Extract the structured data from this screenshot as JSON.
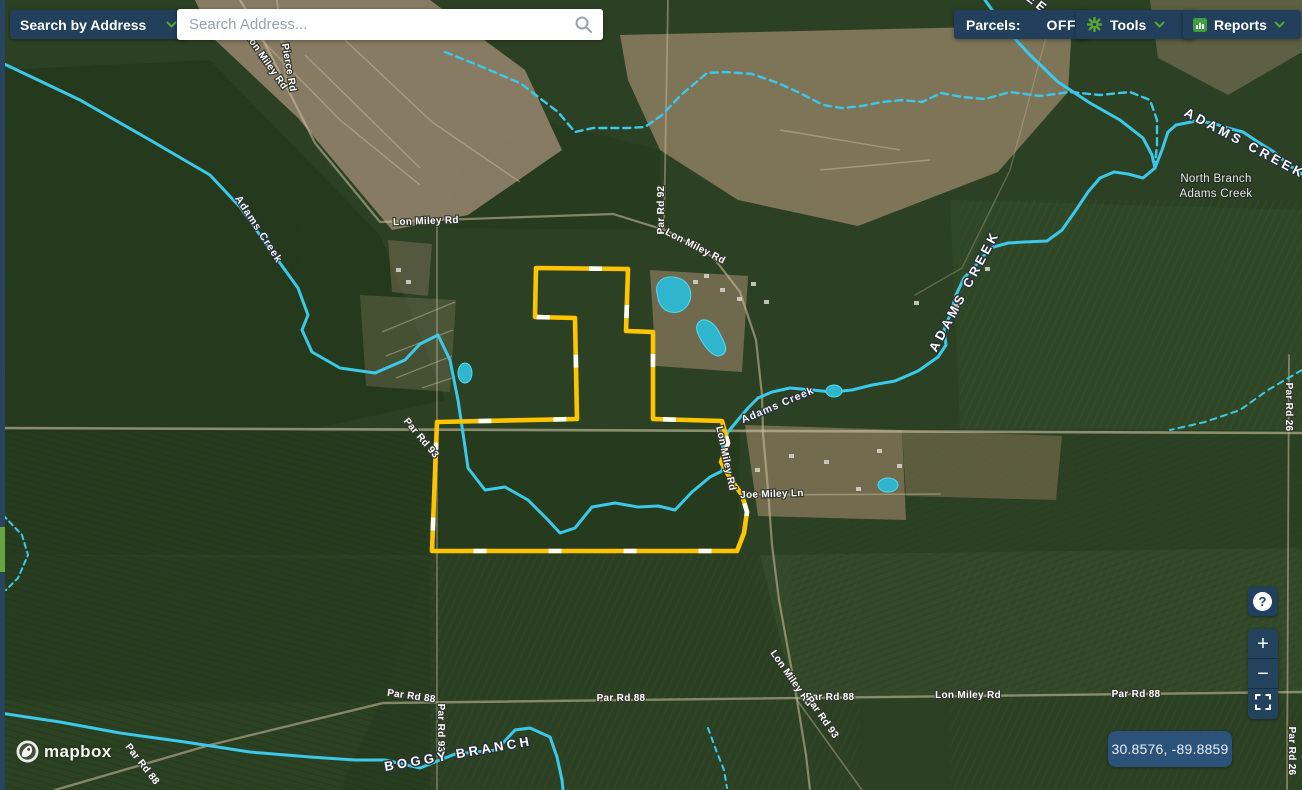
{
  "header": {
    "search_by": {
      "label": "Search by Address"
    },
    "search": {
      "placeholder": "Search Address..."
    },
    "parcels": {
      "label": "Parcels:",
      "state": "OFF"
    },
    "tools": {
      "label": "Tools"
    },
    "reports": {
      "label": "Reports"
    }
  },
  "controls": {
    "help": "?",
    "zoom_in": "+",
    "zoom_out": "−"
  },
  "footer": {
    "attribution": "mapbox",
    "coordinates": "30.8576, -89.8859"
  },
  "colors": {
    "navy_button": "#22405b",
    "accent_green": "#5aa431",
    "parcel_yellow": "#ffc400",
    "creek_cyan": "#3cc9e9",
    "coords_bg": "#2b5278"
  },
  "map_labels": [
    {
      "id": "lon-miley-rd-nw",
      "text": "Lon Miley Rd",
      "x": 264,
      "y": 63,
      "r": 55,
      "cls": "lbl-rd"
    },
    {
      "id": "pierce-rd",
      "text": "Pierce Rd",
      "x": 286,
      "y": 68,
      "r": 80,
      "cls": "lbl-rd"
    },
    {
      "id": "lon-miley-rd-w",
      "text": "Lon Miley Rd",
      "x": 426,
      "y": 224,
      "r": -2,
      "cls": "lbl-rd"
    },
    {
      "id": "par-rd-92",
      "text": "Par Rd 92",
      "x": 664,
      "y": 210,
      "r": -90,
      "cls": "lbl-rd"
    },
    {
      "id": "lon-miley-rd-ne",
      "text": "Lon Miley Rd",
      "x": 694,
      "y": 249,
      "r": 27,
      "cls": "lbl-rd"
    },
    {
      "id": "adams-creek-nw",
      "text": "Adams Creek",
      "x": 256,
      "y": 231,
      "r": 57,
      "cls": "lbl-creek-sm"
    },
    {
      "id": "creek-letters-top",
      "text": "EE",
      "x": 1035,
      "y": 7,
      "r": 38,
      "cls": "lbl-creek"
    },
    {
      "id": "adams-creek-upper",
      "text": "ADAMS CREEK",
      "x": 968,
      "y": 293,
      "r": -62,
      "cls": "lbl-creek"
    },
    {
      "id": "adams-creek-ne",
      "text": "ADAMS CREEK",
      "x": 1243,
      "y": 147,
      "r": 28,
      "cls": "lbl-creek"
    },
    {
      "id": "north-branch-line1",
      "text": "North Branch",
      "x": 1216,
      "y": 182,
      "r": 0,
      "cls": "lbl-place"
    },
    {
      "id": "north-branch-line2",
      "text": "Adams Creek",
      "x": 1216,
      "y": 197,
      "r": 0,
      "cls": "lbl-place"
    },
    {
      "id": "adams-creek-mid",
      "text": "Adams Creek",
      "x": 779,
      "y": 408,
      "r": -23,
      "cls": "lbl-creek-sm"
    },
    {
      "id": "lon-miley-rd-e",
      "text": "Lon Miley Rd",
      "x": 723,
      "y": 459,
      "r": 78,
      "cls": "lbl-rd"
    },
    {
      "id": "joe-miley-ln",
      "text": "Joe Miley Ln",
      "x": 772,
      "y": 497,
      "r": -2,
      "cls": "lbl-rd"
    },
    {
      "id": "par-rd-93-w",
      "text": "Par Rd 93",
      "x": 419,
      "y": 440,
      "r": 50,
      "cls": "lbl-rd"
    },
    {
      "id": "par-rd-26-mid",
      "text": "Par Rd 26",
      "x": 1286,
      "y": 407,
      "r": 90,
      "cls": "lbl-rd"
    },
    {
      "id": "par-rd-26-se",
      "text": "Par Rd 26",
      "x": 1289,
      "y": 751,
      "r": 90,
      "cls": "lbl-rd"
    },
    {
      "id": "lon-miley-rd-s",
      "text": "Lon Miley Rd",
      "x": 789,
      "y": 680,
      "r": 55,
      "cls": "lbl-rd"
    },
    {
      "id": "par-rd-88-sw",
      "text": "Par Rd 88",
      "x": 411,
      "y": 699,
      "r": 8,
      "cls": "lbl-rd"
    },
    {
      "id": "par-rd-93-s",
      "text": "Par Rd 93",
      "x": 438,
      "y": 728,
      "r": 90,
      "cls": "lbl-rd"
    },
    {
      "id": "par-rd-88-mid",
      "text": "Par Rd 88",
      "x": 621,
      "y": 701,
      "r": 0,
      "cls": "lbl-rd"
    },
    {
      "id": "par-rd-88-se",
      "text": "Par Rd 88",
      "x": 830,
      "y": 700,
      "r": 0,
      "cls": "lbl-rd"
    },
    {
      "id": "par-rd-93-se",
      "text": "Par Rd 93",
      "x": 820,
      "y": 719,
      "r": 55,
      "cls": "lbl-rd"
    },
    {
      "id": "lon-miley-rd-s2",
      "text": "Lon Miley Rd",
      "x": 968,
      "y": 698,
      "r": 0,
      "cls": "lbl-rd"
    },
    {
      "id": "par-rd-88-e",
      "text": "Par Rd 88",
      "x": 1136,
      "y": 697,
      "r": 0,
      "cls": "lbl-rd"
    },
    {
      "id": "par-rd-88-swd",
      "text": "Par Rd 88",
      "x": 140,
      "y": 766,
      "r": 52,
      "cls": "lbl-rd"
    },
    {
      "id": "boggy-branch",
      "text": "BOGGY BRANCH",
      "x": 459,
      "y": 758,
      "r": -10,
      "cls": "lbl-creek"
    }
  ]
}
